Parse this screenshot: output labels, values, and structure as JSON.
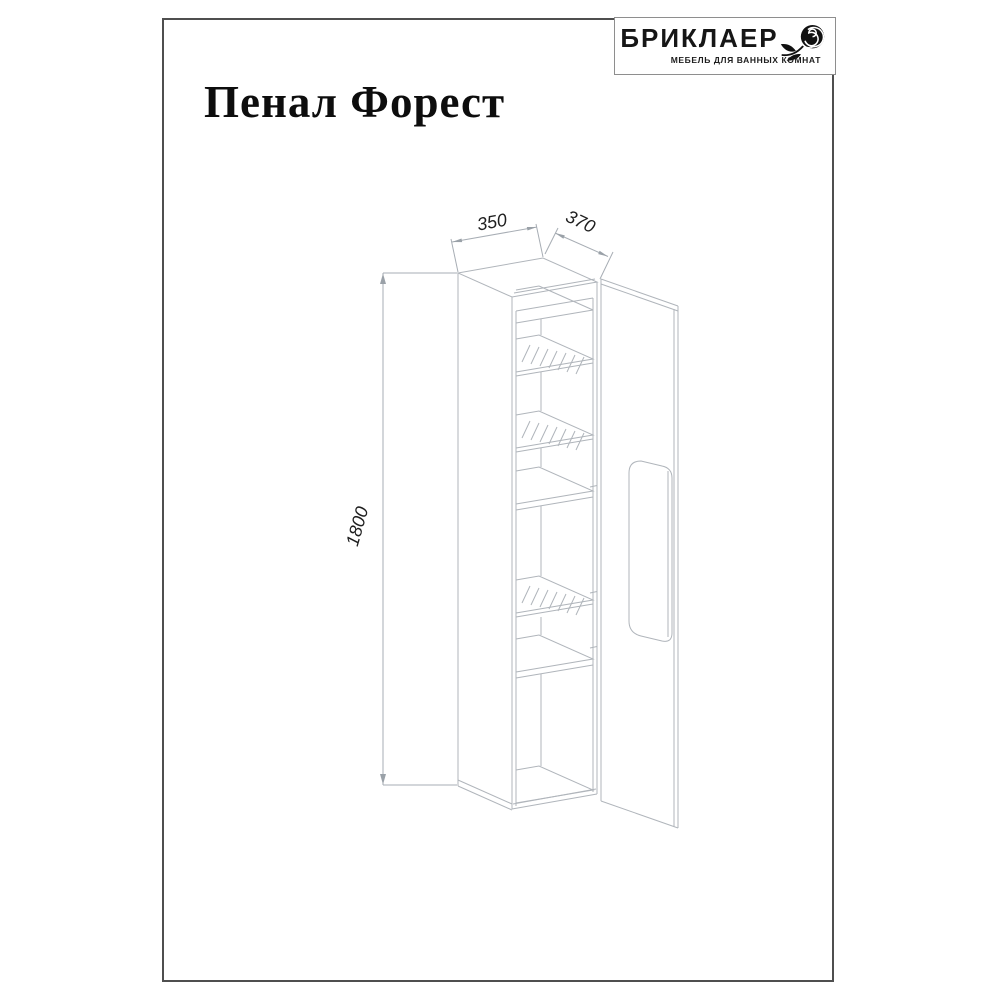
{
  "page": {
    "title": "Пенал Форест"
  },
  "logo": {
    "brand": "БРИКЛАЕР",
    "tagline": "МЕБЕЛЬ ДЛЯ ВАННЫХ КОМНАТ",
    "icon": "rose-icon"
  },
  "drawing": {
    "parts": [
      "cabinet-carcass",
      "glass-shelf",
      "glass-shelf",
      "solid-shelf",
      "glass-shelf",
      "solid-shelf",
      "open-door",
      "door-handle-recess"
    ],
    "dimensions": {
      "width": "350",
      "depth": "370",
      "height": "1800"
    }
  }
}
